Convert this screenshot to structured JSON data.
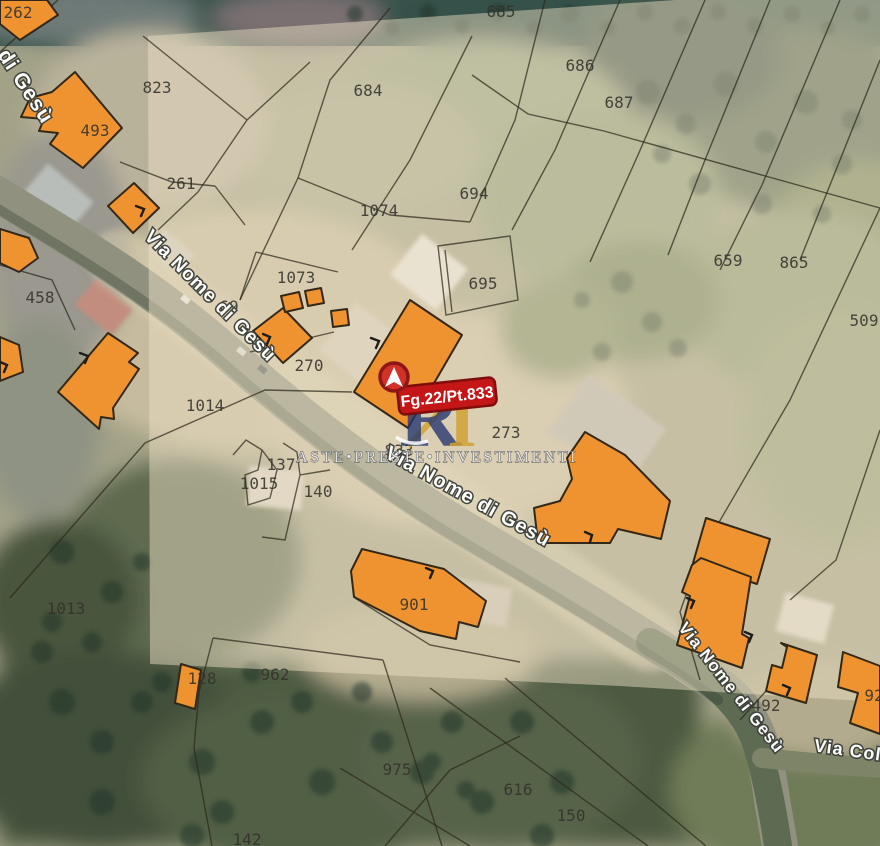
{
  "map": {
    "marker": {
      "label": "Fg.22/Pt.833"
    },
    "watermark": {
      "text": "ASTE•PRESTE•INVESTIMENTI",
      "logo_blue": "R",
      "logo_gold": "I"
    },
    "roads": [
      {
        "label": "di Gesù"
      },
      {
        "label": "Via Nome di Gesù"
      },
      {
        "label": "Via Nome di Gesù"
      },
      {
        "label": "Via Nome di Gesù"
      },
      {
        "label": "Via Col"
      }
    ],
    "parcels": [
      {
        "label": "685"
      },
      {
        "label": "686"
      },
      {
        "label": "687"
      },
      {
        "label": "684"
      },
      {
        "label": "823"
      },
      {
        "label": "493"
      },
      {
        "label": "262"
      },
      {
        "label": "261"
      },
      {
        "label": "1074"
      },
      {
        "label": "694"
      },
      {
        "label": "695"
      },
      {
        "label": "659"
      },
      {
        "label": "865"
      },
      {
        "label": "509"
      },
      {
        "label": "458"
      },
      {
        "label": "1073"
      },
      {
        "label": "69"
      },
      {
        "label": "270"
      },
      {
        "label": "1014"
      },
      {
        "label": "273"
      },
      {
        "label": "833"
      },
      {
        "label": "137"
      },
      {
        "label": "1015"
      },
      {
        "label": "140"
      },
      {
        "label": "1013"
      },
      {
        "label": "901"
      },
      {
        "label": "962"
      },
      {
        "label": "128"
      },
      {
        "label": "975"
      },
      {
        "label": "616"
      },
      {
        "label": "150"
      },
      {
        "label": "492"
      },
      {
        "label": "92"
      },
      {
        "label": "142"
      }
    ],
    "colors": {
      "building_fill": "#ef9331",
      "building_stroke": "#332817",
      "marker_red": "#c41616",
      "marker_border": "#7e0d0d",
      "overlay_tint": "#ece0c3",
      "road_label": "#ffffff",
      "parcel_label": "#33312b"
    }
  }
}
